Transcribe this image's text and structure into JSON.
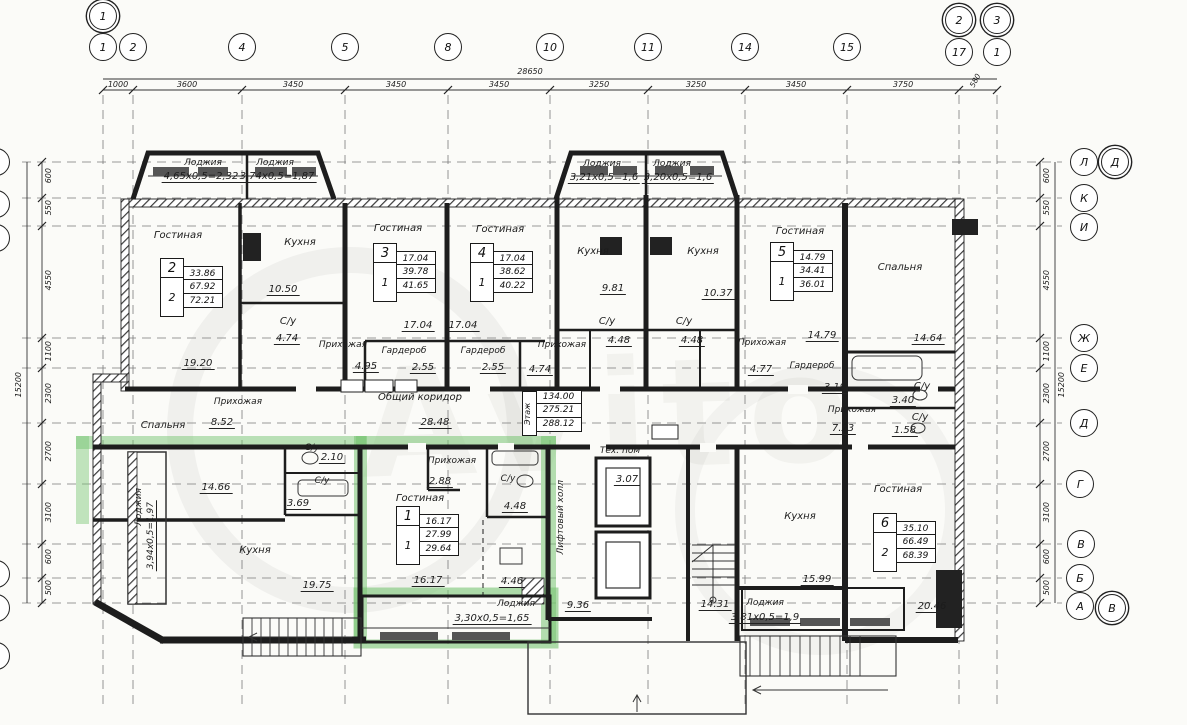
{
  "watermark": "Avito",
  "axes": {
    "top": {
      "bubbles": [
        "1",
        "2",
        "4",
        "5",
        "8",
        "10",
        "11",
        "14",
        "15",
        "17",
        "1"
      ],
      "doubles": {
        "left": "1",
        "right1": "2",
        "right2": "3"
      },
      "dims": [
        "1000",
        "3600",
        "3450",
        "3450",
        "3450",
        "3250",
        "3250",
        "3450",
        "3750",
        "580"
      ],
      "total": "28650"
    },
    "right": {
      "bubbles": [
        "Л",
        "К",
        "И",
        "Ж",
        "Е",
        "Д",
        "Г",
        "В",
        "Б",
        "А"
      ],
      "doubles": {
        "top": "Д",
        "bottom": "В"
      },
      "dims": [
        "600",
        "550",
        "4550",
        "1100",
        "2300",
        "2700",
        "3100",
        "600",
        "500"
      ],
      "total": "15200"
    },
    "left": {
      "dims": [
        "600",
        "550",
        "4550",
        "1100",
        "2300",
        "2700",
        "3100",
        "600",
        "500"
      ],
      "total": "15200"
    }
  },
  "words": {
    "loggia": "Лоджия",
    "kitchen": "Кухня",
    "bath": "С/у",
    "living": "Гостиная",
    "hall": "Прихожая",
    "wardrobe": "Гардероб",
    "bedroom": "Спальня",
    "tech": "Тех. пом",
    "corridor": "Общий коридор",
    "lift_hall": "Лифтовый холл"
  },
  "vals": {
    "lg1": "4,65х0,5=2,32",
    "lg2": "3,74х0,5=1,87",
    "lg3": "3,21х0,5=1,6",
    "lg4": "3,20х0,5=1,6",
    "lg5": "3,30х0,5=1,65",
    "lg6": "3,81х0,5=1,9",
    "lg7": "3,94х0,5=1,97",
    "a2_room1": "19.20",
    "a2_kitchen": "10.50",
    "a2_bath": "4.74",
    "a3_room": "17.04",
    "a3_wr": "2.55",
    "a3_hall": "4.95",
    "a4_room": "17.04",
    "a4_wr": "2.55",
    "a4_hall": "4.74",
    "a5_k1": "9.81",
    "a5_k2": "10.37",
    "a5_b1": "4.48",
    "a5_b2": "4.48",
    "a5_hall": "4.77",
    "a5_room": "14.79",
    "a5_wr": "3.19",
    "bedroom_right": "14.64",
    "bath_r1": "3.40",
    "bath_r2": "1.58",
    "corridor": "28.48",
    "mid_hall": "8.52",
    "mid_bedroom": "14.66",
    "mid_b1": "2.10",
    "mid_b2": "3.69",
    "mid_kitchen": "19.75",
    "a1_hall": "2.88",
    "a1_bath": "4.48",
    "a1_room": "16.17",
    "a1_kitchen": "4.46",
    "tech": "3.07",
    "lift": "9.36",
    "stairs": "14.31",
    "a6_kitchen": "15.99",
    "a6_hall": "7.23",
    "a6_room": "20.46"
  },
  "stamps": {
    "s1": {
      "num": "1",
      "rooms": "1",
      "v": [
        "16.17",
        "27.99",
        "29.64"
      ]
    },
    "s2": {
      "num": "2",
      "rooms": "2",
      "v": [
        "33.86",
        "67.92",
        "72.21"
      ]
    },
    "s3": {
      "num": "3",
      "rooms": "1",
      "v": [
        "17.04",
        "39.78",
        "41.65"
      ]
    },
    "s4": {
      "num": "4",
      "rooms": "1",
      "v": [
        "17.04",
        "38.62",
        "40.22"
      ]
    },
    "s5": {
      "num": "5",
      "rooms": "1",
      "v": [
        "14.79",
        "34.41",
        "36.01"
      ]
    },
    "s6": {
      "num": "6",
      "rooms": "2",
      "v": [
        "35.10",
        "66.49",
        "68.39"
      ]
    },
    "floor": {
      "label": "Этаж",
      "v": [
        "134.00",
        "275.21",
        "288.12"
      ]
    }
  }
}
